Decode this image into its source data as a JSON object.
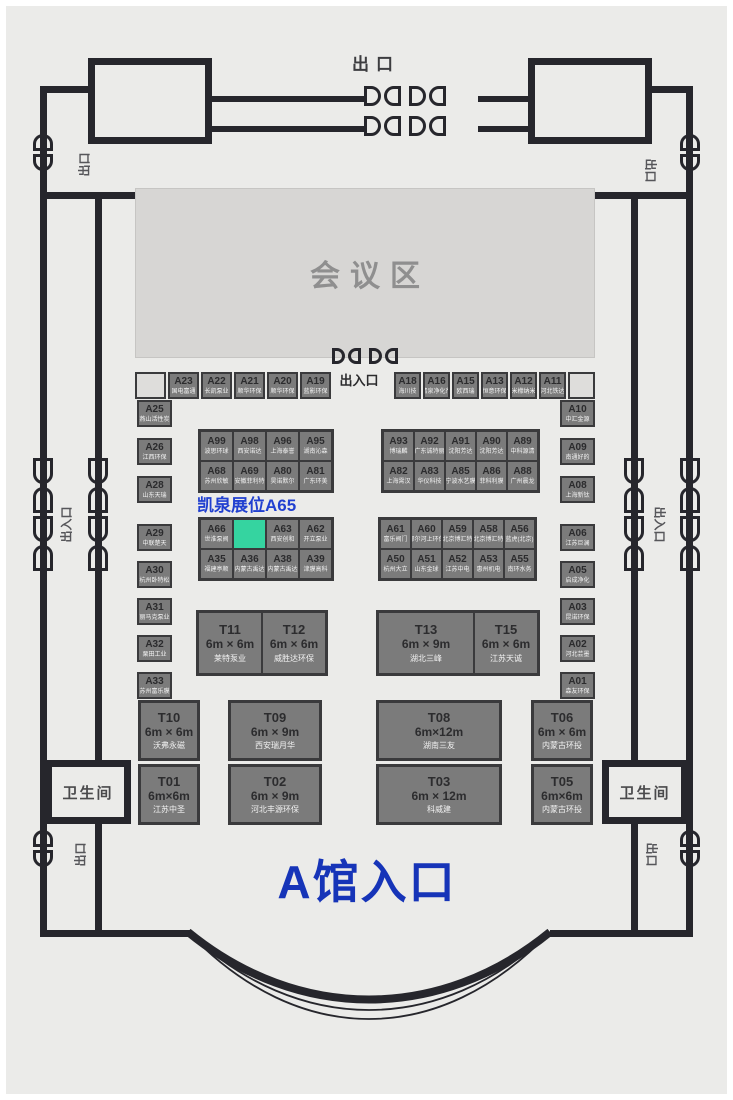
{
  "labels": {
    "exit_top": "出口",
    "entrance_center": "出入口",
    "entrance_side_left": "出入口",
    "entrance_side_right": "出入口",
    "exit_side_top_left": "出口",
    "exit_side_top_right": "出口",
    "exit_side_bottom_left": "出口",
    "exit_side_bottom_right": "出口",
    "conference": "会议区",
    "restroom_left": "卫生间",
    "restroom_right": "卫生间",
    "highlight_booth": "凯泉展位A65",
    "hall_entrance": "A馆入口"
  },
  "colors": {
    "floor": "#ebebe9",
    "wall": "#26262c",
    "booth_fill": "#7b7b7b",
    "booth_border": "#3a3a3c",
    "booth_number": "#2b2b2d",
    "booth_name": "#f2f2f2",
    "highlight_fill": "#35d4a0",
    "accent_blue": "#1634b8",
    "conference_fill": "#d7d6d4"
  },
  "rows": {
    "top_left": [
      {
        "id": "",
        "name": "",
        "empty": true
      },
      {
        "id": "A23",
        "name": "国电富通"
      },
      {
        "id": "A22",
        "name": "长凯泵业"
      },
      {
        "id": "A21",
        "name": "顺华环保"
      },
      {
        "id": "A20",
        "name": "顺华环保"
      },
      {
        "id": "A19",
        "name": "蓝影环保"
      }
    ],
    "top_right": [
      {
        "id": "A18",
        "name": "海川技"
      },
      {
        "id": "A16",
        "name": "清泉净化剂"
      },
      {
        "id": "A15",
        "name": "欧西瑞"
      },
      {
        "id": "A13",
        "name": "恒意环保"
      },
      {
        "id": "A12",
        "name": "米檬纳米"
      },
      {
        "id": "A11",
        "name": "河北铁达"
      },
      {
        "id": "",
        "name": "",
        "empty": true
      }
    ]
  },
  "columns": {
    "left_top": [
      {
        "id": "A25",
        "name": "燕山活性炭"
      },
      {
        "id": "A26",
        "name": "江西环保"
      },
      {
        "id": "A28",
        "name": "山东天瑞"
      }
    ],
    "left_bottom": [
      {
        "id": "A29",
        "name": "中联楚天"
      },
      {
        "id": "A30",
        "name": "杭州卧特松"
      },
      {
        "id": "A31",
        "name": "丽马克泵业"
      },
      {
        "id": "A32",
        "name": "栗田工业"
      },
      {
        "id": "A33",
        "name": "苏州富乐膜"
      }
    ],
    "right_top": [
      {
        "id": "A10",
        "name": "中汇金源"
      },
      {
        "id": "A09",
        "name": "南通好的"
      },
      {
        "id": "A08",
        "name": "上海新钛"
      }
    ],
    "right_bottom": [
      {
        "id": "A06",
        "name": "江苏巨澜"
      },
      {
        "id": "A05",
        "name": "启成净化"
      },
      {
        "id": "A03",
        "name": "昆诺环保"
      },
      {
        "id": "A02",
        "name": "河北芸墨"
      },
      {
        "id": "A01",
        "name": "森友环保"
      }
    ]
  },
  "blocks": {
    "b1l": [
      {
        "id": "A99",
        "name": "波思环球"
      },
      {
        "id": "A98",
        "name": "西安诺达"
      },
      {
        "id": "A96",
        "name": "上海泰誉"
      },
      {
        "id": "A95",
        "name": "湖南沁森"
      },
      {
        "id": "A68",
        "name": "苏州欣敏"
      },
      {
        "id": "A69",
        "name": "安徽菲利特"
      },
      {
        "id": "A80",
        "name": "昊诺默尔"
      },
      {
        "id": "A81",
        "name": "广东环美"
      }
    ],
    "b1r": [
      {
        "id": "A93",
        "name": "博瑞麟"
      },
      {
        "id": "A92",
        "name": "广东诚特丽"
      },
      {
        "id": "A91",
        "name": "沈阳芳达"
      },
      {
        "id": "A90",
        "name": "沈阳芳达"
      },
      {
        "id": "A89",
        "name": "中科源清"
      },
      {
        "id": "A82",
        "name": "上海霄汉"
      },
      {
        "id": "A83",
        "name": "华仪科技"
      },
      {
        "id": "A85",
        "name": "宁波水艺膜"
      },
      {
        "id": "A86",
        "name": "菲科利膜"
      },
      {
        "id": "A88",
        "name": "广州晨龙"
      }
    ],
    "b2l": [
      {
        "id": "A66",
        "name": "世淮泵阀"
      },
      {
        "id": "A65",
        "name": "",
        "highlight": true
      },
      {
        "id": "A63",
        "name": "西安创和"
      },
      {
        "id": "A62",
        "name": "开立泵业"
      },
      {
        "id": "A35",
        "name": "福建亭顺"
      },
      {
        "id": "A36",
        "name": "内蒙古禹达"
      },
      {
        "id": "A38",
        "name": "内蒙古禹达"
      },
      {
        "id": "A39",
        "name": "津膜高科"
      }
    ],
    "b2r": [
      {
        "id": "A61",
        "name": "富乐阀门"
      },
      {
        "id": "A60",
        "name": "鄂尔河上环保"
      },
      {
        "id": "A59",
        "name": "北京博汇特"
      },
      {
        "id": "A58",
        "name": "北京博汇特"
      },
      {
        "id": "A56",
        "name": "蓝虎(北京)"
      },
      {
        "id": "A50",
        "name": "杭州大立"
      },
      {
        "id": "A51",
        "name": "山东金球"
      },
      {
        "id": "A52",
        "name": "江苏中电"
      },
      {
        "id": "A53",
        "name": "惠州机电"
      },
      {
        "id": "A55",
        "name": "南环水务"
      }
    ]
  },
  "t_blocks": {
    "a": [
      {
        "id": "T11",
        "size": "6m × 6m",
        "name": "莱特泵业"
      },
      {
        "id": "T12",
        "size": "6m × 6m",
        "name": "威胜达环保"
      }
    ],
    "b": [
      {
        "id": "T13",
        "size": "6m × 9m",
        "name": "湖北三峰"
      },
      {
        "id": "T15",
        "size": "6m × 6m",
        "name": "江苏天诚"
      }
    ]
  },
  "t_singles": {
    "t10": {
      "id": "T10",
      "size": "6m × 6m",
      "name": "沃弗永磁"
    },
    "t09": {
      "id": "T09",
      "size": "6m × 9m",
      "name": "西安瑞月华"
    },
    "t08": {
      "id": "T08",
      "size": "6m×12m",
      "name": "湖南三友"
    },
    "t06": {
      "id": "T06",
      "size": "6m × 6m",
      "name": "内蒙古环投"
    },
    "t01": {
      "id": "T01",
      "size": "6m×6m",
      "name": "江苏中圣"
    },
    "t02": {
      "id": "T02",
      "size": "6m × 9m",
      "name": "河北丰源环保"
    },
    "t03": {
      "id": "T03",
      "size": "6m × 12m",
      "name": "科威建"
    },
    "t05": {
      "id": "T05",
      "size": "6m×6m",
      "name": "内蒙古环投"
    }
  }
}
